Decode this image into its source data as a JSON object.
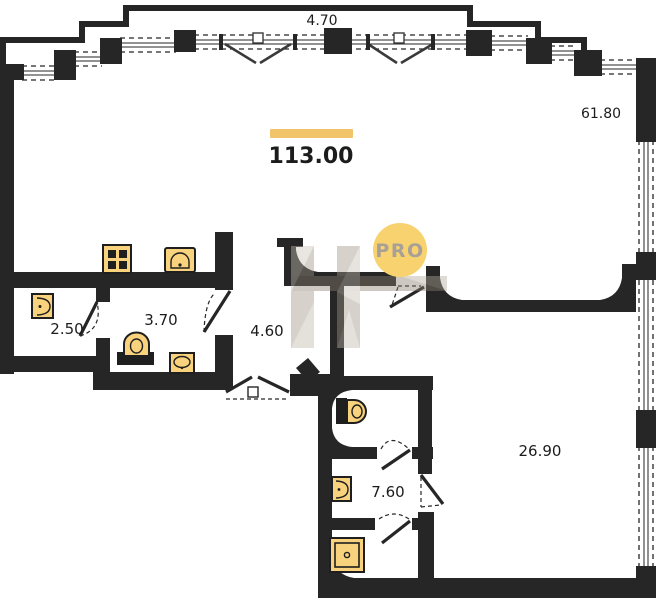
{
  "plan": {
    "dimensions": {
      "top_width": "4.70",
      "living_area": "61.80"
    },
    "total_area": "113.00",
    "rooms": {
      "storage": "2.50",
      "bathroom": "3.70",
      "hallway": "4.60",
      "shower_bathroom": "7.60",
      "bedroom": "26.90"
    }
  },
  "watermark": {
    "badge": "PRO"
  },
  "fixtures": [
    "stove",
    "kitchen-sink",
    "washbasin",
    "toilet",
    "hand-basin",
    "wc-toilet",
    "shower-tray"
  ],
  "colors": {
    "wall": "#262626",
    "fixture_fill": "#f8d27c",
    "fixture_stroke": "#1f1f1f",
    "accent_bar": "#f2c46a",
    "badge_bg": "#f8d26f",
    "badge_text": "#a8a096",
    "label_text": "#1c1c1c",
    "watermark": "#9e9486"
  }
}
